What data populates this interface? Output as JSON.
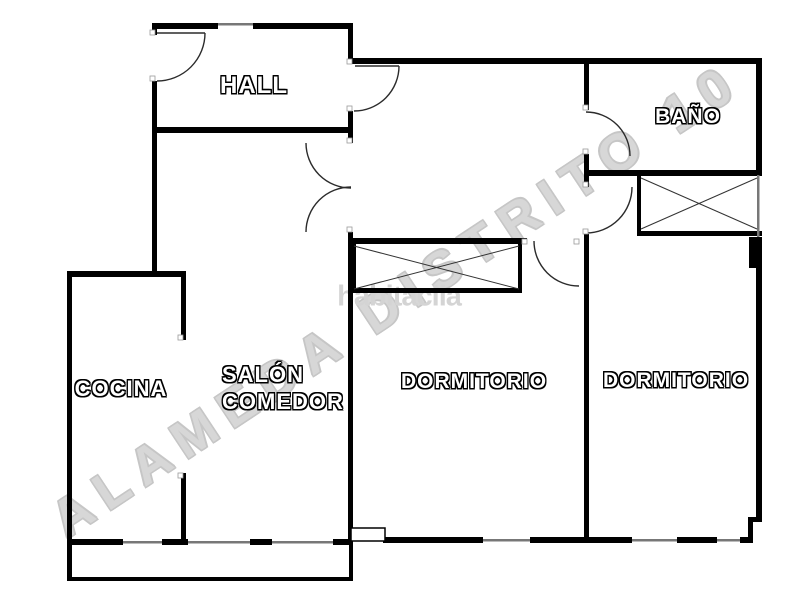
{
  "plan": {
    "title": "apartment floor plan",
    "rooms": [
      {
        "name": "hall",
        "label": "HALL"
      },
      {
        "name": "bano",
        "label": "BAÑO"
      },
      {
        "name": "cocina",
        "label": "COCINA"
      },
      {
        "name": "salon-comedor",
        "label_line1": "SALÓN",
        "label_line2": "COMEDOR"
      },
      {
        "name": "dormitorio-1",
        "label": "DORMITORIO"
      },
      {
        "name": "dormitorio-2",
        "label": "DORMITORIO"
      }
    ],
    "watermarks": {
      "diagonal": "ALAMEDA DISTRITO 10",
      "brand": "habitaclia"
    },
    "colors": {
      "background": "#ffffff",
      "wall": "#000000",
      "door_line": "#2b2b2b",
      "window_line": "#777777",
      "label_text": "#ffffff",
      "label_outline": "#000000",
      "watermark_outline": "#c6c6c6",
      "brand_gray": "#d4d4d4"
    }
  }
}
